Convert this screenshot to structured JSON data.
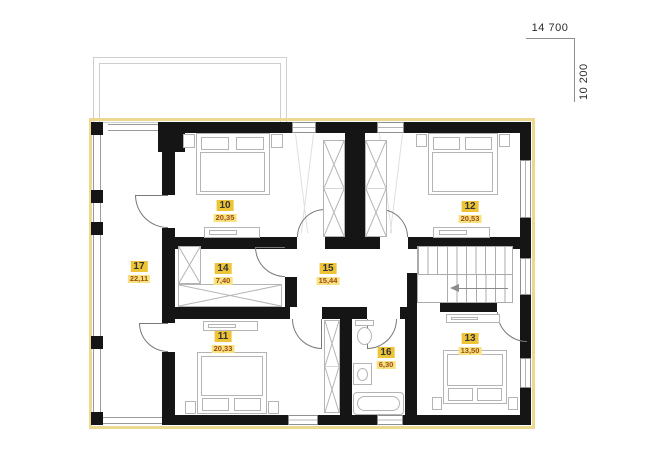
{
  "dimensions": {
    "width_label": "14 700",
    "height_label": "10 200"
  },
  "rooms": [
    {
      "number": "10",
      "area": "20,35"
    },
    {
      "number": "11",
      "area": "20,33"
    },
    {
      "number": "12",
      "area": "20,53"
    },
    {
      "number": "13",
      "area": "13,50"
    },
    {
      "number": "14",
      "area": "7,40"
    },
    {
      "number": "15",
      "area": "15,44"
    },
    {
      "number": "16",
      "area": "6,30"
    },
    {
      "number": "17",
      "area": "22,11"
    }
  ],
  "colors": {
    "wall": "#151515",
    "insulation_outline": "#ecd88f",
    "room_number_bg": "#eec437",
    "room_number_text": "#333333",
    "room_area_bg": "#f6e27f",
    "room_area_text": "#a04a10",
    "furniture_line": "#b4b4b4"
  }
}
